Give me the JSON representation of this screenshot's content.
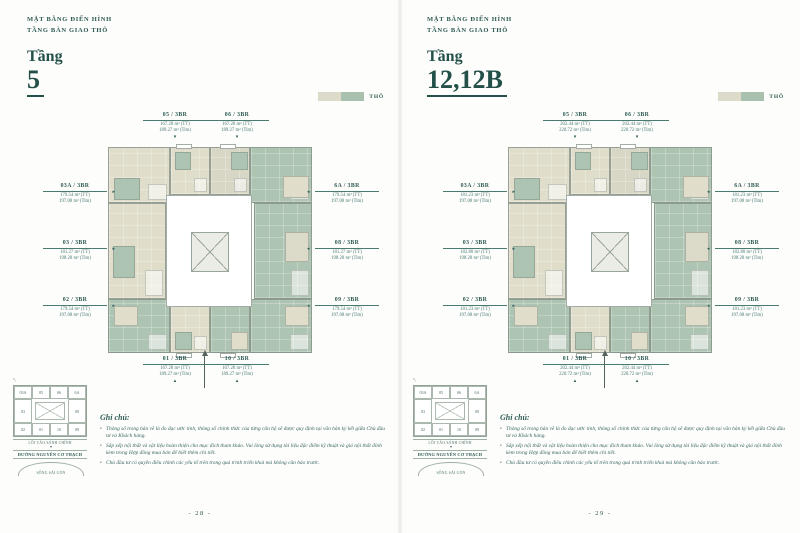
{
  "colors": {
    "accent_teal": "#2d5a52",
    "swatch_raw_beige": "#dcdac9",
    "swatch_raw_green": "#a9c0ae",
    "plan_beige": "#e0decb",
    "plan_green": "#aec4b2"
  },
  "icons": {
    "leader_down": "▾",
    "leader_up": "▴",
    "leader_left": "◂",
    "leader_right": "▸",
    "bullet": "•",
    "pen_mark": "↑"
  },
  "minimap": {
    "top": [
      "03A",
      "05",
      "06",
      "6A"
    ],
    "mid": [
      "03",
      "08"
    ],
    "bottom": [
      "02",
      "01",
      "10",
      "09"
    ],
    "entrance": "LỐI VÀO SẢNH CHÍNH",
    "street": "ĐƯỜNG NGUYỄN CƠ THẠCH",
    "river": "SÔNG SÀI GÒN"
  },
  "notes": {
    "title": "Ghi chú:",
    "items": [
      "Thông số trong bản vẽ là đo đạc ước tính, thông số chính thức của từng căn hộ sẽ được quy định tại văn bản ký kết giữa Chủ đầu tư và Khách hàng.",
      "Sắp xếp nội thất và vật liệu hoàn thiện cho mục đích tham khảo. Vui lòng sử dụng tài liệu đặc điểm kỹ thuật và giá nội thất đính kèm trong Hợp đồng mua bán để biết thêm chi tiết.",
      "Chủ đầu tư có quyền điều chỉnh các yếu tố trên trong quá trình triển khai mà không cần báo trước."
    ]
  },
  "pages": [
    {
      "header": {
        "line1": "MẶT BẰNG ĐIỂN HÌNH",
        "line2": "TẦNG BÀN GIAO THÔ",
        "floor_word": "Tầng",
        "floor_number": "5"
      },
      "legend": {
        "label": "THÔ"
      },
      "units": {
        "top": [
          {
            "name": "05 / 3BR",
            "tt": "167.28 m² (TT)",
            "tim": "189.27 m² (Tim)"
          },
          {
            "name": "06 / 3BR",
            "tt": "167.28 m² (TT)",
            "tim": "189.27 m² (Tim)"
          }
        ],
        "left": [
          {
            "name": "03A / 3BR",
            "tt": "179.54 m² (TT)",
            "tim": "197.08 m² (Tim)"
          },
          {
            "name": "03 / 3BR",
            "tt": "181.27 m² (TT)",
            "tim": "198.28 m² (Tim)"
          },
          {
            "name": "02 / 3BR",
            "tt": "179.54 m² (TT)",
            "tim": "197.08 m² (Tim)"
          }
        ],
        "right": [
          {
            "name": "6A / 3BR",
            "tt": "179.54 m² (TT)",
            "tim": "197.08 m² (Tim)"
          },
          {
            "name": "08 / 3BR",
            "tt": "181.27 m² (TT)",
            "tim": "198.28 m² (Tim)"
          },
          {
            "name": "09 / 3BR",
            "tt": "179.54 m² (TT)",
            "tim": "197.08 m² (Tim)"
          }
        ],
        "bottom": [
          {
            "name": "01 / 3BR",
            "tt": "167.28 m² (TT)",
            "tim": "189.27 m² (Tim)"
          },
          {
            "name": "10 / 3BR",
            "tt": "167.28 m² (TT)",
            "tim": "189.27 m² (Tim)"
          }
        ]
      },
      "page_number": "- 28 -"
    },
    {
      "header": {
        "line1": "MẶT BẰNG ĐIỂN HÌNH",
        "line2": "TẦNG BÀN GIAO THÔ",
        "floor_word": "Tầng",
        "floor_number": "12,12B"
      },
      "legend": {
        "label": "THÔ"
      },
      "units": {
        "top": [
          {
            "name": "05 / 3BR",
            "tt": "202.44 m² (TT)",
            "tim": "220.72 m² (Tim)"
          },
          {
            "name": "06 / 3BR",
            "tt": "202.44 m² (TT)",
            "tim": "220.72 m² (Tim)"
          }
        ],
        "left": [
          {
            "name": "03A / 3BR",
            "tt": "181.23 m² (TT)",
            "tim": "197.08 m² (Tim)"
          },
          {
            "name": "03 / 3BR",
            "tt": "182.80 m² (TT)",
            "tim": "198.28 m² (Tim)"
          },
          {
            "name": "02 / 3BR",
            "tt": "181.23 m² (TT)",
            "tim": "197.08 m² (Tim)"
          }
        ],
        "right": [
          {
            "name": "6A / 3BR",
            "tt": "181.23 m² (TT)",
            "tim": "197.08 m² (Tim)"
          },
          {
            "name": "08 / 3BR",
            "tt": "182.80 m² (TT)",
            "tim": "198.28 m² (Tim)"
          },
          {
            "name": "09 / 3BR",
            "tt": "181.23 m² (TT)",
            "tim": "197.08 m² (Tim)"
          }
        ],
        "bottom": [
          {
            "name": "01 / 3BR",
            "tt": "202.44 m² (TT)",
            "tim": "220.72 m² (Tim)"
          },
          {
            "name": "10 / 3BR",
            "tt": "202.44 m² (TT)",
            "tim": "220.72 m² (Tim)"
          }
        ]
      },
      "page_number": "- 29 -"
    }
  ]
}
